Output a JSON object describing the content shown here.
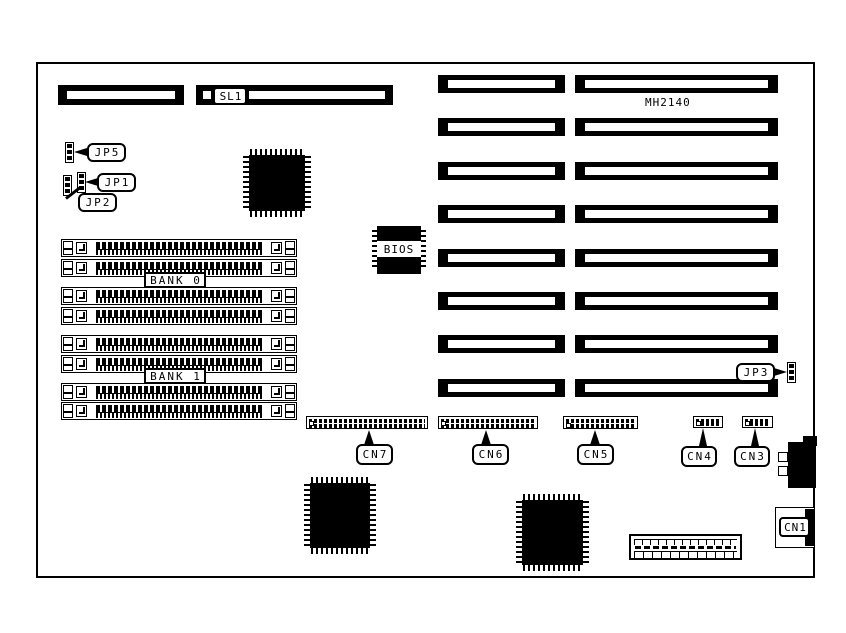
{
  "board": {
    "model": "MH2140",
    "colors": {
      "ink": "#000000",
      "paper": "#ffffff"
    }
  },
  "labels": {
    "sl1": "SL1",
    "jp5": "JP5",
    "jp1": "JP1",
    "jp2": "JP2",
    "jp3": "JP3",
    "bios": "BIOS",
    "bank0": "BANK 0",
    "bank1": "BANK 1",
    "cn7": "CN7",
    "cn6": "CN6",
    "cn5": "CN5",
    "cn4": "CN4",
    "cn3": "CN3",
    "cn1": "CN1"
  }
}
